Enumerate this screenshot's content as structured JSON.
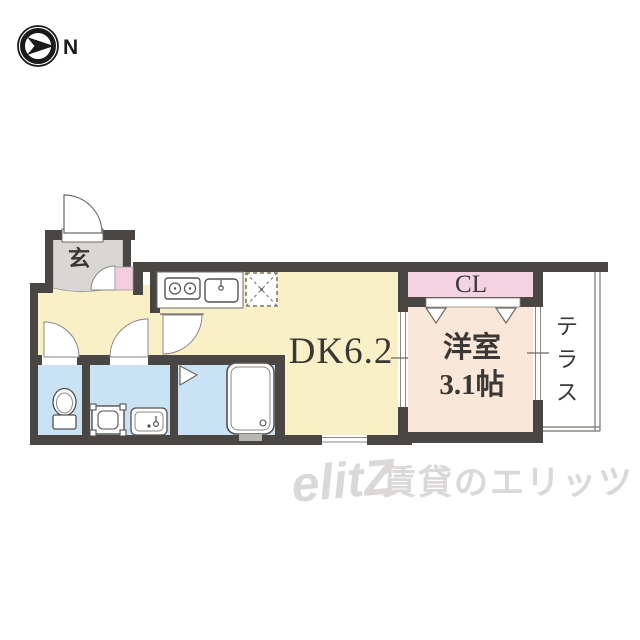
{
  "compass": {
    "label": "N"
  },
  "floorplan": {
    "rooms": {
      "genkan": {
        "label": "玄"
      },
      "dk": {
        "label": "DK6.2"
      },
      "closet": {
        "label": "CL"
      },
      "western": {
        "label_line1": "洋室",
        "label_line2": "3.1帖"
      },
      "terrace": {
        "label": "テラス",
        "char1": "テ",
        "char2": "ラ",
        "char3": "ス"
      }
    },
    "colors": {
      "wall": "#4a4643",
      "thin_line": "#6e6b68",
      "dk_fill": "#faf0c8",
      "western_fill": "#f9e7d9",
      "closet_fill": "#f5d2e2",
      "entry_closet_fill": "#f4cede",
      "wet_area_fill": "#c9e3f4",
      "genkan_fill": "#d8d7d5",
      "label_color": "#3a3734"
    }
  },
  "watermark": {
    "logo": "elitZ",
    "text": "賃貸のエリッツ",
    "color": "#dbd9d7"
  }
}
